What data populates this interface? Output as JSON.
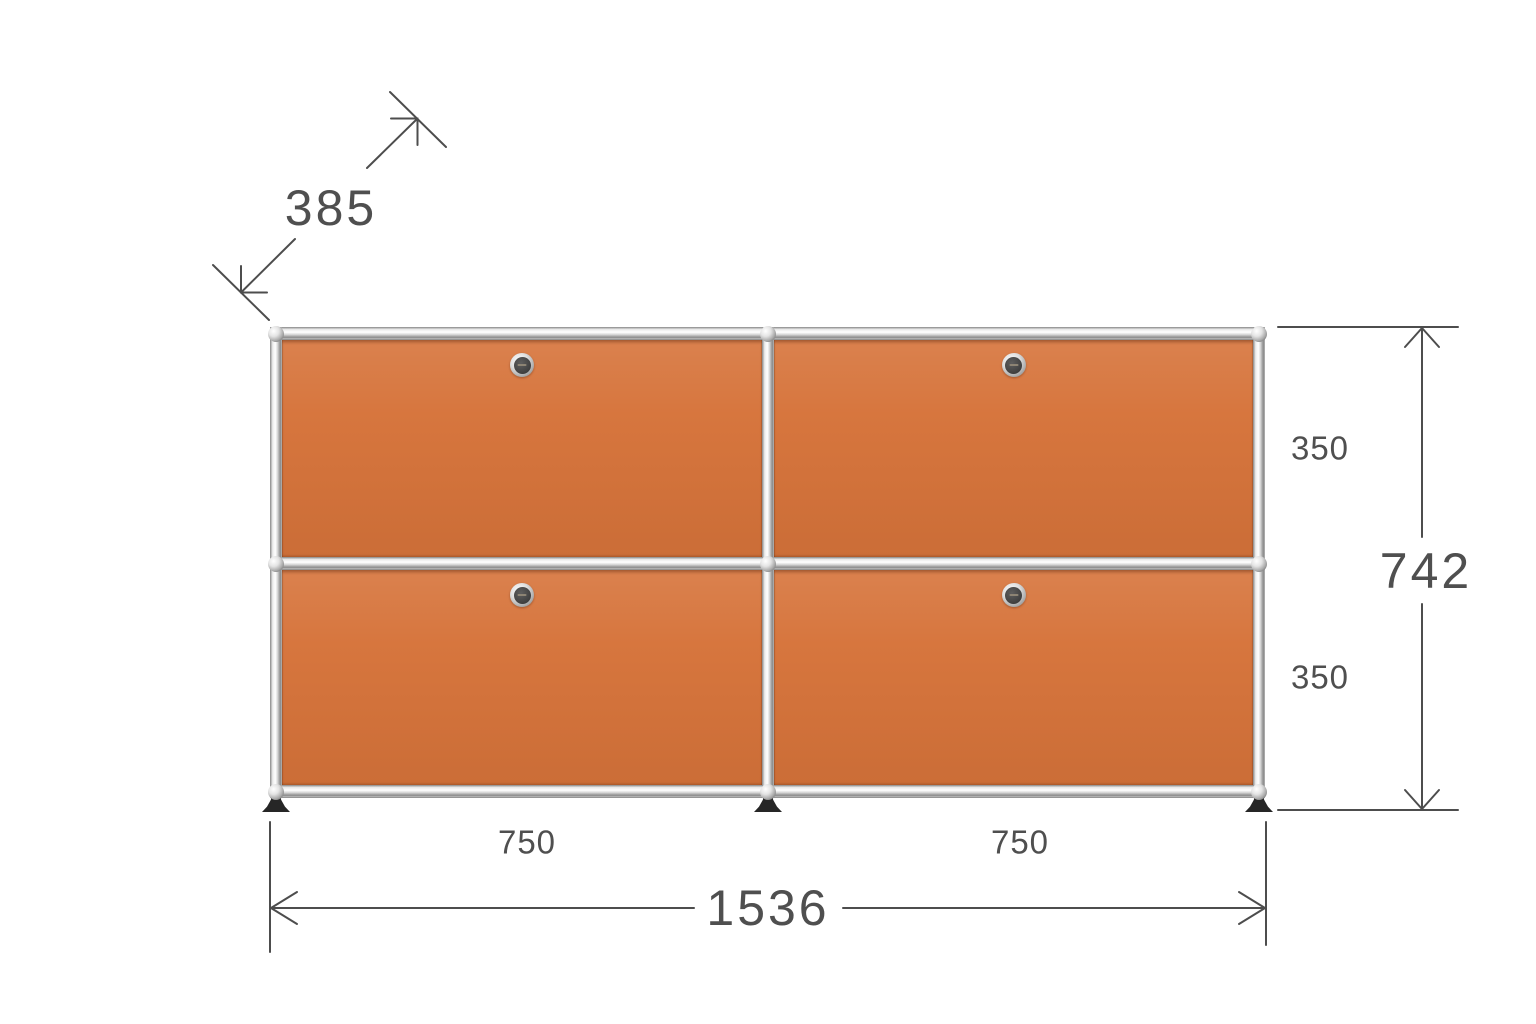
{
  "dimension_labels": {
    "depth": "385",
    "total_height": "742",
    "top_row_height": "350",
    "bottom_row_height": "350",
    "left_bay_width": "750",
    "right_bay_width": "750",
    "total_width": "1536"
  },
  "cabinet": {
    "rows": 2,
    "columns": 2,
    "doors": 4,
    "handles": 4,
    "feet": 3
  },
  "colors": {
    "panel_orange": "#d6733a",
    "dimension_line": "#4d4d4d",
    "dimension_text": "#4f4f4f",
    "chrome_light": "#ffffff",
    "chrome_mid": "#d8d8d8",
    "chrome_dark": "#8a8a8a",
    "foot_black": "#262626",
    "background": "#ffffff"
  }
}
